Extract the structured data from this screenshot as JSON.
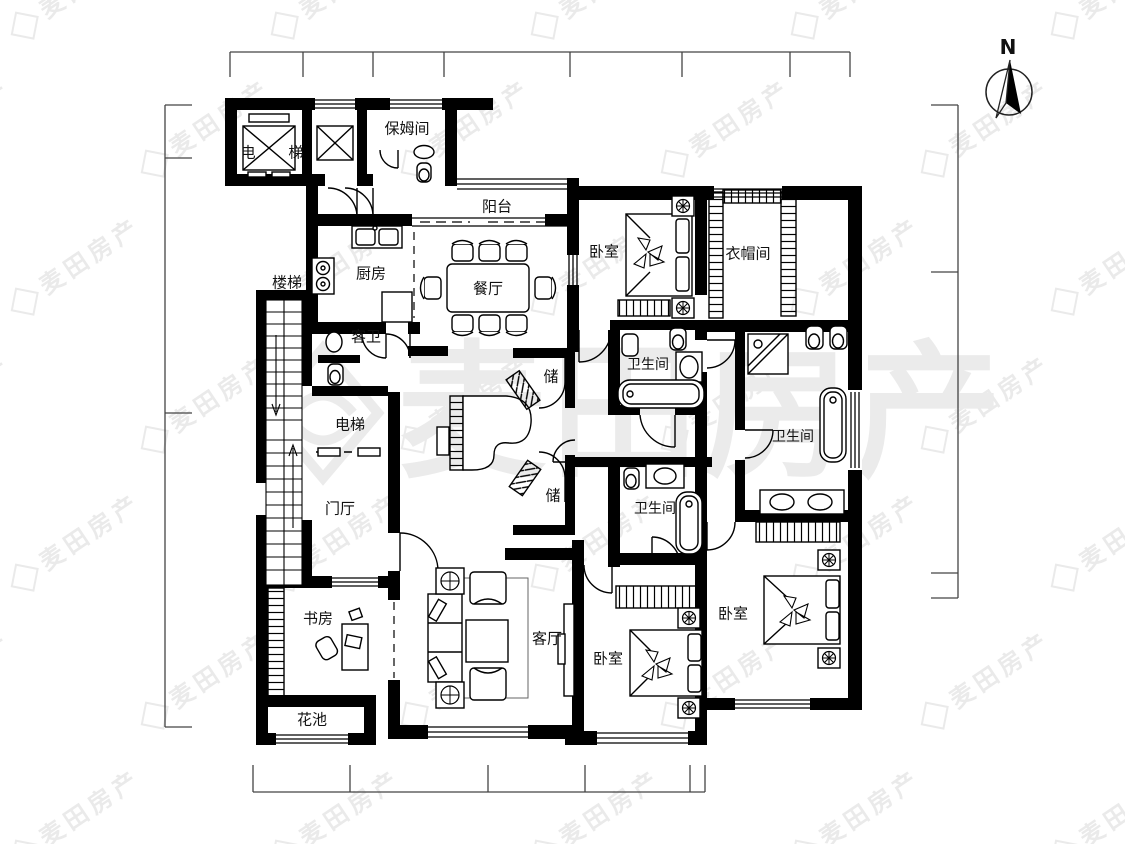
{
  "title": "residential-floor-plan",
  "colors": {
    "wall": "#000000",
    "line": "#1a1a1a",
    "dimension": "#444444",
    "watermark_light": "#ebebeb",
    "background": "#ffffff"
  },
  "compass": {
    "label": "N"
  },
  "watermark": {
    "text": "麦田房产"
  },
  "rooms": {
    "elevator_shaft": {
      "label": "电 梯"
    },
    "nanny_room": {
      "label": "保姆间"
    },
    "balcony": {
      "label": "阳台"
    },
    "kitchen": {
      "label": "厨房"
    },
    "dining_room": {
      "label": "餐厅"
    },
    "bedroom_top": {
      "label": "卧室"
    },
    "cloakroom": {
      "label": "衣帽间"
    },
    "stairs": {
      "label": "楼梯"
    },
    "guest_bath": {
      "label": "客卫"
    },
    "bath_top": {
      "label": "卫生间"
    },
    "bath_right": {
      "label": "卫生间"
    },
    "private_elevator": {
      "label": "电梯"
    },
    "storage_upper": {
      "label": "储"
    },
    "storage_lower": {
      "label": "储"
    },
    "foyer": {
      "label": "门厅"
    },
    "bath_mid": {
      "label": "卫生间"
    },
    "study": {
      "label": "书房"
    },
    "living_room": {
      "label": "客厅"
    },
    "bedroom_mid": {
      "label": "卧室"
    },
    "bedroom_right": {
      "label": "卧室"
    },
    "flower_bed": {
      "label": "花池"
    }
  }
}
